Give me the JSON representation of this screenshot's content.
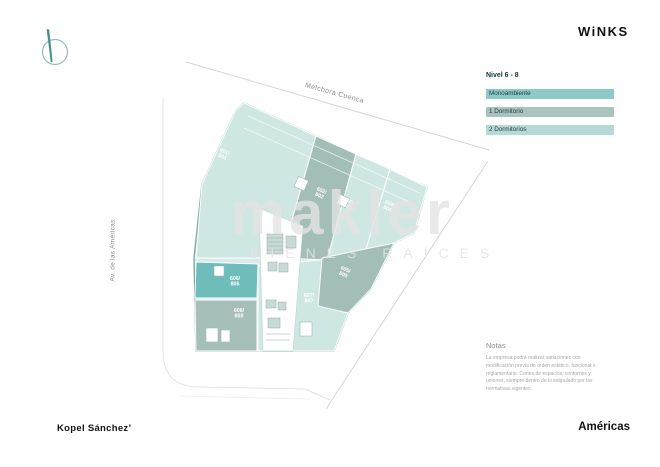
{
  "header": {
    "logo": "WiNKS"
  },
  "legend": {
    "title": "Nivel 6 - 8",
    "items": [
      {
        "label": "Monoambiente",
        "color": "#8ccac8"
      },
      {
        "label": "1 Dormitorio",
        "color": "#a9c4bd"
      },
      {
        "label": "2 Dormitorios",
        "color": "#b7d9d4"
      }
    ]
  },
  "streets": {
    "top": "Melchora Cuenca",
    "left": "Av. de las Américas"
  },
  "plan": {
    "level": "Nivel 6 - 8",
    "units": [
      {
        "label": "601/801",
        "x": 224,
        "y": 153,
        "rot": 24
      },
      {
        "label": "602/802",
        "x": 321,
        "y": 192,
        "rot": 24
      },
      {
        "label": "603/803",
        "x": 349,
        "y": 203,
        "rot": 24
      },
      {
        "label": "604/804",
        "x": 389,
        "y": 205,
        "rot": 24
      },
      {
        "label": "605/805",
        "x": 345,
        "y": 271,
        "rot": 24
      },
      {
        "label": "606/806",
        "x": 235,
        "y": 280,
        "rot": 0
      },
      {
        "label": "607/807",
        "x": 309,
        "y": 297,
        "rot": 0
      },
      {
        "label": "608/808",
        "x": 239,
        "y": 312,
        "rot": 0
      }
    ]
  },
  "watermark": {
    "line1": "makler",
    "line2": "BIENES RAÍCES"
  },
  "notes": {
    "title": "Notas",
    "body": "La empresa podrá realizar variaciones con modificación previa de orden estético, funcional o reglamentario. Cortes de espacios, contornos y uniones, siempre dentro de lo estipulado por las normativas vigentes."
  },
  "footer": {
    "developer": "Kopel Sánchez’",
    "project": "Américas"
  },
  "colors": {
    "plan_light_teal": "#cfe7e3",
    "plan_dark_sage": "#a3beb6",
    "plan_mono_teal": "#6fbdba",
    "plan_sage_gray": "#a6bfb8",
    "plan_outline": "#7aaea8"
  }
}
